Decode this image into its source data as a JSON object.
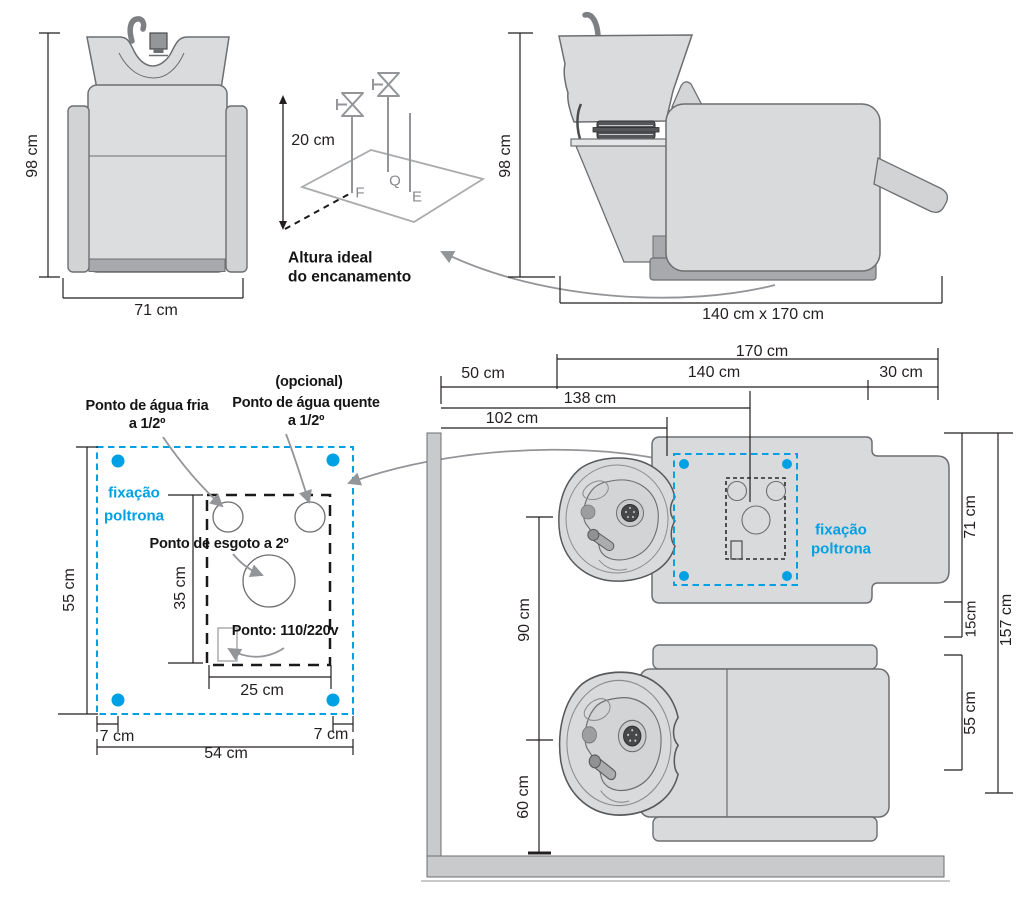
{
  "colors": {
    "accent_blue": "#00a1e4",
    "line_dark": "#231f20",
    "arrow_gray": "#939598"
  },
  "front_view": {
    "height": "98 cm",
    "width": "71 cm"
  },
  "iso_view": {
    "height": "20 cm",
    "point_cold": "F",
    "point_hot": "Q",
    "point_drain": "E",
    "caption_line1": "Altura ideal",
    "caption_line2": "do encanamento"
  },
  "side_view": {
    "height": "98 cm",
    "footprint": "140 cm x 170 cm"
  },
  "floor_detail": {
    "fixation_line1": "fixação",
    "fixation_line2": "poltrona",
    "cold_water_line1": "Ponto de água fria",
    "cold_water_line2": "a 1/2º",
    "hot_water_note": "(opcional)",
    "hot_water_line1": "Ponto de água quente",
    "hot_water_line2": "a 1/2º",
    "drain_label": "Ponto de esgoto a 2º",
    "power_label": "Ponto: 110/220v",
    "dim_height": "55 cm",
    "dim_inner_height": "35 cm",
    "dim_inner_width": "25 cm",
    "dim_margin_left": "7 cm",
    "dim_margin_right": "7 cm",
    "dim_width": "54 cm"
  },
  "top_view": {
    "fixation_line1": "fixação",
    "fixation_line2": "poltrona",
    "dim_total_length": "170 cm",
    "dim_wall_offset": "50 cm",
    "dim_chair_length": "140 cm",
    "dim_extension": "30 cm",
    "dim_drain_offset": "138 cm",
    "dim_fixation_offset": "102 cm",
    "dim_basin_gap": "90 cm",
    "dim_wall_clearance": "60 cm",
    "dim_chair_width": "71 cm",
    "dim_gap": "15cm",
    "dim_seat_width": "55 cm",
    "dim_total_width": "157 cm"
  }
}
